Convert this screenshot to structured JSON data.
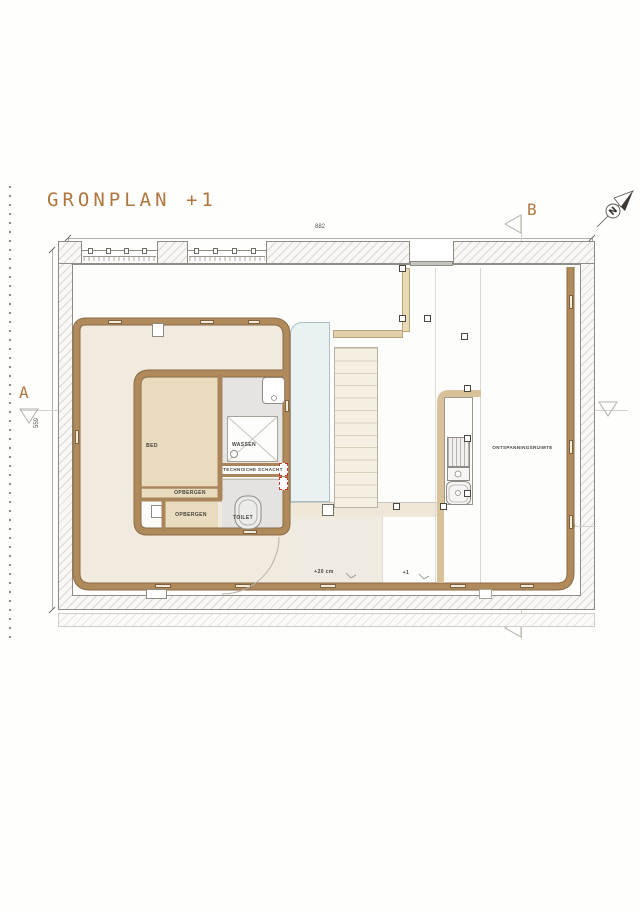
{
  "title": "GRONPLAN +1",
  "north": {
    "label": "N"
  },
  "sections": {
    "a": "A",
    "b": "B"
  },
  "dimensions": {
    "width_total": "882",
    "height_left": "559"
  },
  "rooms": {
    "bed": "BED",
    "wassen": "WASSEN",
    "technische_schacht": "TECHNISCHE SCHACHT",
    "opbergen_upper": "OPBERGEN",
    "opbergen_lower": "OPBERGEN",
    "toilet": "TOILET",
    "ontspanningsruimte": "ONTSPANNINGSRUIMTE"
  },
  "levels": {
    "floor": "+20 cm",
    "stair": "+1"
  },
  "colors": {
    "accent": "#b0763d",
    "wood_wall": "#b18a5c",
    "tan_wall": "#ddc59c",
    "floor_beige": "#f0eadf",
    "room_tan": "#e9dbbd",
    "room_gray": "#e5e4e2",
    "glass_blue": "#e9f1f2",
    "shaft_red": "#c0392b"
  }
}
